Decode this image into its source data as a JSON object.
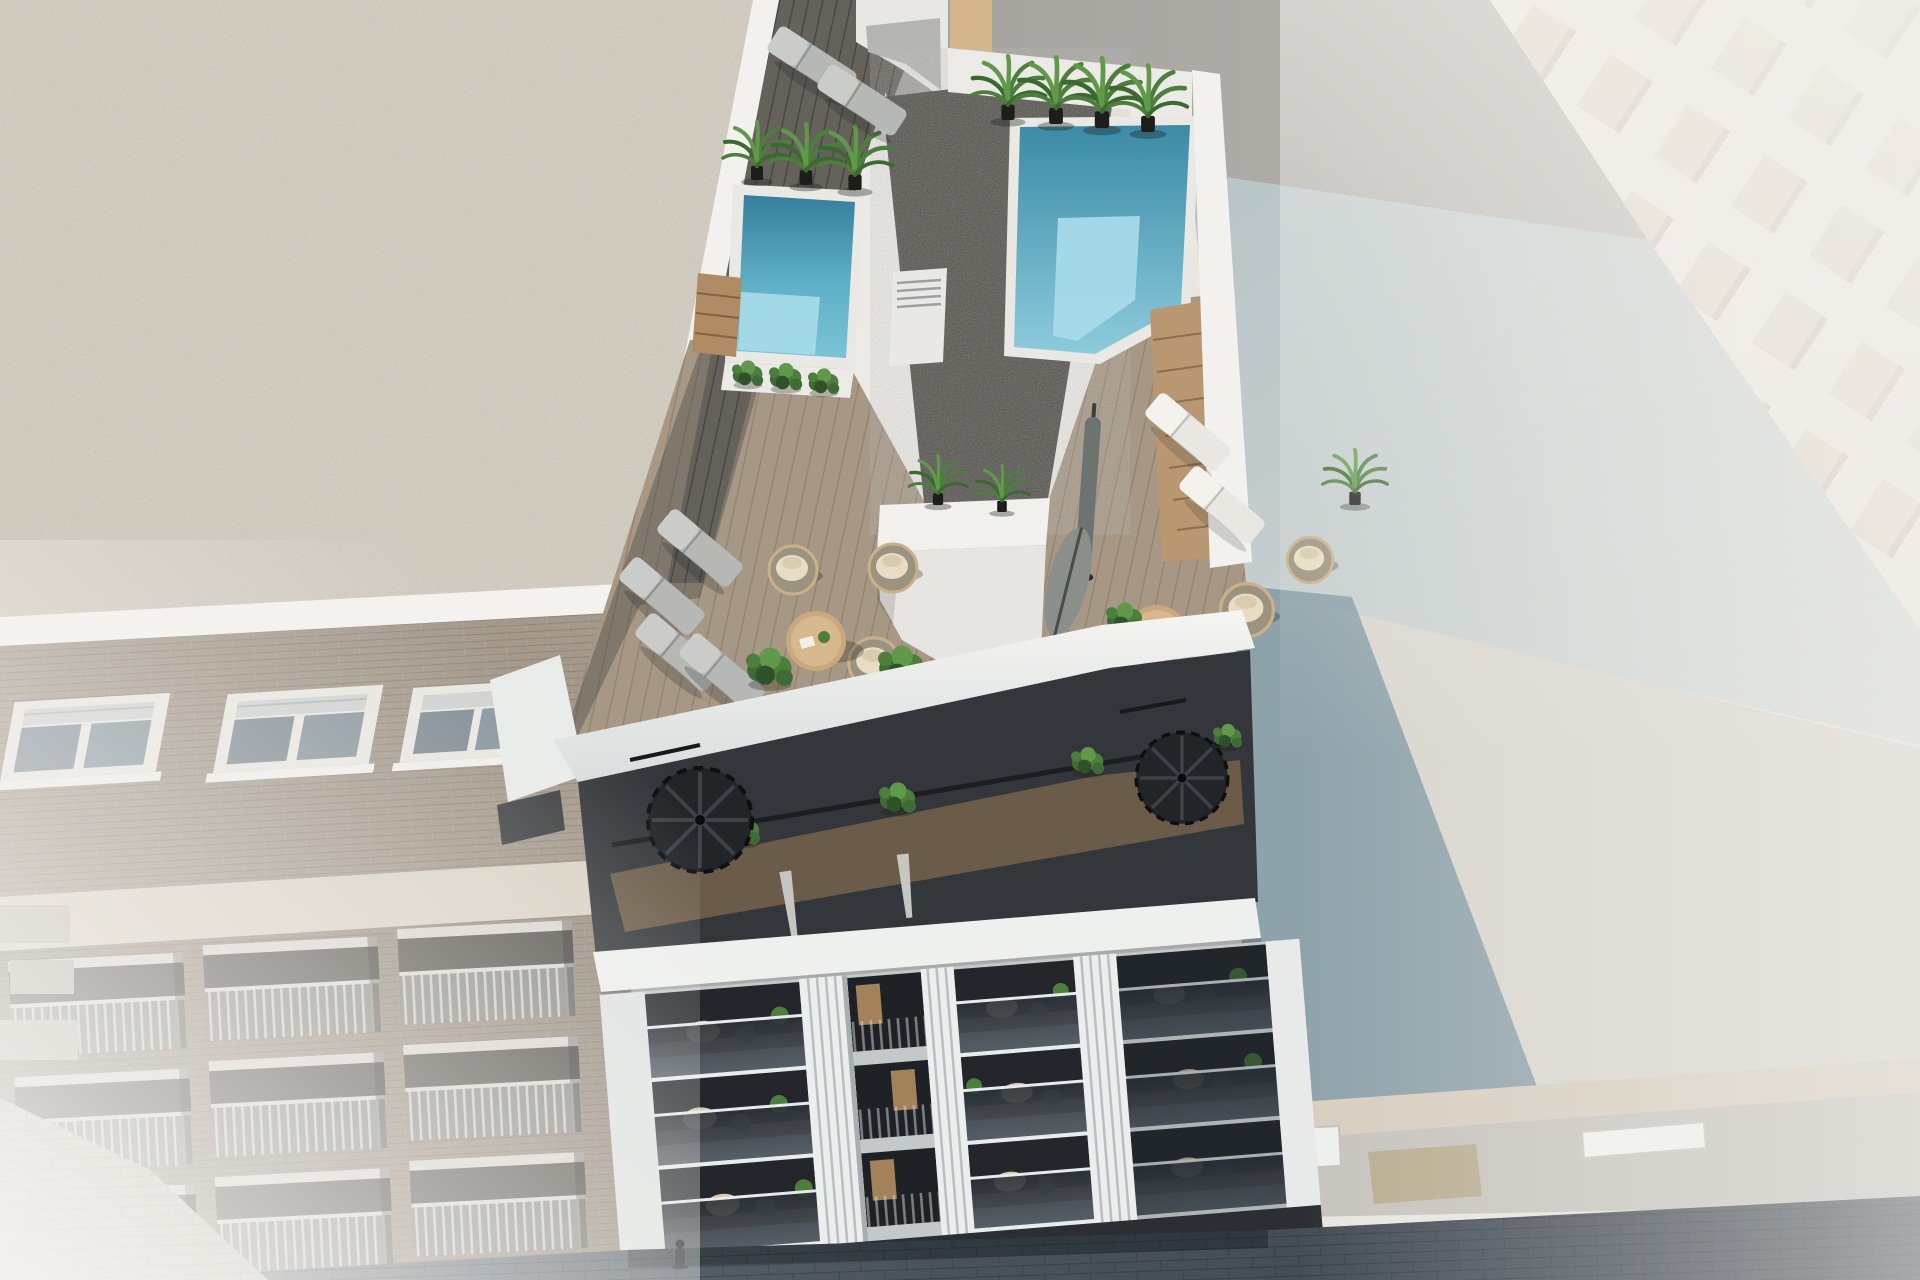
{
  "canvas": {
    "width": 1920,
    "height": 1280
  },
  "scene": {
    "description": "Aerial 3D architectural render of a modern white apartment building with a rooftop terrace: two turquoise plunge pools, a dark gravel roof strip, timber decking with sun loungers, hanging rattan chairs, round tables, parasols, potted palms, two black spiral staircases, glass-front balconies below, flanked by a brick neighbour block on the left, hazy white buildings on the right and a shaded cobblestone street at the bottom with one pedestrian."
  },
  "inventory": {
    "main_building": {
      "rooftop_pools": 2,
      "gravel_roof_strips": 1,
      "rooftop_palms": 7,
      "terrace_palms": 3,
      "sun_loungers_grey": 4,
      "sun_loungers_white": 2,
      "rooftop_loungers": 2,
      "hanging_chairs": 5,
      "coffee_tables": 2,
      "parasols": 4,
      "spiral_staircases": 2,
      "balcony_floors": 3,
      "planter_boxes": 3
    },
    "left_building": {
      "upper_windows": 3,
      "balconies": 9,
      "roof": "light gravel"
    },
    "right_background": {
      "tall_building_window_grid": true,
      "flat_roofs": 3,
      "skylights": 3
    },
    "street": {
      "surface": "dark cobblestone in shadow",
      "pedestrians": 1,
      "light_pavement_corner": true
    }
  },
  "palette": {
    "haze_base": "#e9e6e1",
    "timber_strip": "#d6b68d",
    "tall_facade": "#efeae3",
    "cornice_stone": "#d7cec0",
    "roof_teal": "#8099a3",
    "roof_light": "#d9d6cf",
    "skylight_white": "#eef0ed",
    "gravel_tan": "#b9ad90",
    "left_gravel": "#d5cec0",
    "white_parapet": "#f2f1ed",
    "white_cornice": "#f4f2ee",
    "brick_upper": "#a3988a",
    "band_cream": "#d9d2c5",
    "brick_lower": "#998d7f",
    "pavement_light": "#c8c4b9",
    "deck_dark": "#64625b",
    "gravel_dark": "#504e48",
    "vent_white": "#e9e8e4",
    "pool_surround": "#e9e8e3",
    "pool_deep": "#357f9c",
    "pool_light": "#79c3d6",
    "pool_shallow": "#a7dbe9",
    "steps_wood": "#b08b63",
    "planter_white": "#eceae6",
    "main_white": "#e8e7e3",
    "main_white_soft": "#ebeae5",
    "deck_wood": "#a69884",
    "core_white": "#f1f0ec",
    "core_face": "#e6e5e1",
    "divider_white": "#edecec",
    "penthouse_dark": "#33363a",
    "penthouse_wood": "#70604b",
    "slab_white": "#eef0ee",
    "facade_shade": "#c3c8c9",
    "pilaster_white": "#eceeed",
    "pilaster_shade": "#dfe3e2",
    "opening_dark": "#23272b",
    "floor_wood": "#7a6750",
    "ground_dark": "#2b2f34",
    "street_dark": "#3e4650",
    "street_mid": "#6d767e",
    "curtain_tan": "#c49a66",
    "chair_beige": "#d9c7a4",
    "table_dark": "#4e5357",
    "umbrella_grey": "#6f7370",
    "umbrella_light": "#8b8f8c",
    "umbrella_folded": "#c5c6c2",
    "lounger_grey": "#b5b8b5",
    "lounger_white": "#e9e7e1",
    "papasan_frame": "#c9b089",
    "papasan_cushion": "#e8ddc4",
    "table_wood": "#c9a87c",
    "palm_green": "#4c7f3b",
    "shrub_green": "#3f6b35",
    "person_dark": "#232629"
  }
}
